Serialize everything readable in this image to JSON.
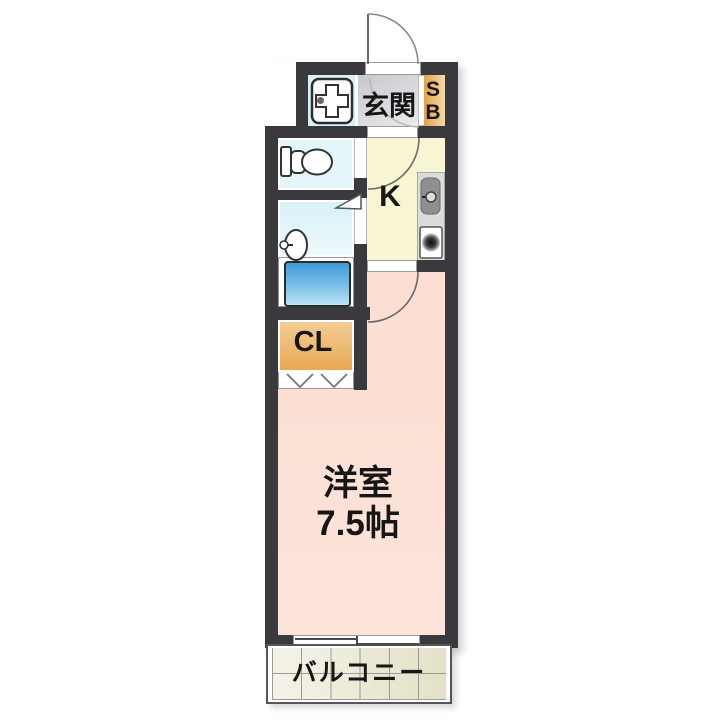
{
  "floorplan": {
    "labels": {
      "entrance": "玄関",
      "shoe_box_line1": "S",
      "shoe_box_line2": "B",
      "kitchen": "K",
      "closet": "CL",
      "room_name": "洋室",
      "room_size": "7.5帖",
      "balcony": "バルコニー"
    },
    "colors": {
      "wall": "#3a3a3e",
      "entrance_floor": "#d9d9dd",
      "shoe_box": "#eab269",
      "kitchen_floor": "#f8f6d2",
      "sanitary_floor": "#dcf3f9",
      "closet": "#edbb73",
      "main_room_floor": "#fcdfd3",
      "balcony_tile": "#eae8d2",
      "bathtub": "#4da3da",
      "kitchen_counter": "#dbdbd7"
    },
    "fixtures": [
      "entrance-door-swing",
      "washing-machine-pan",
      "toilet",
      "washbasin",
      "bathtub",
      "kitchen-sink",
      "stove-burner",
      "interior-door-swing",
      "washroom-door-triangle",
      "folding-closet-door",
      "sliding-window"
    ]
  }
}
